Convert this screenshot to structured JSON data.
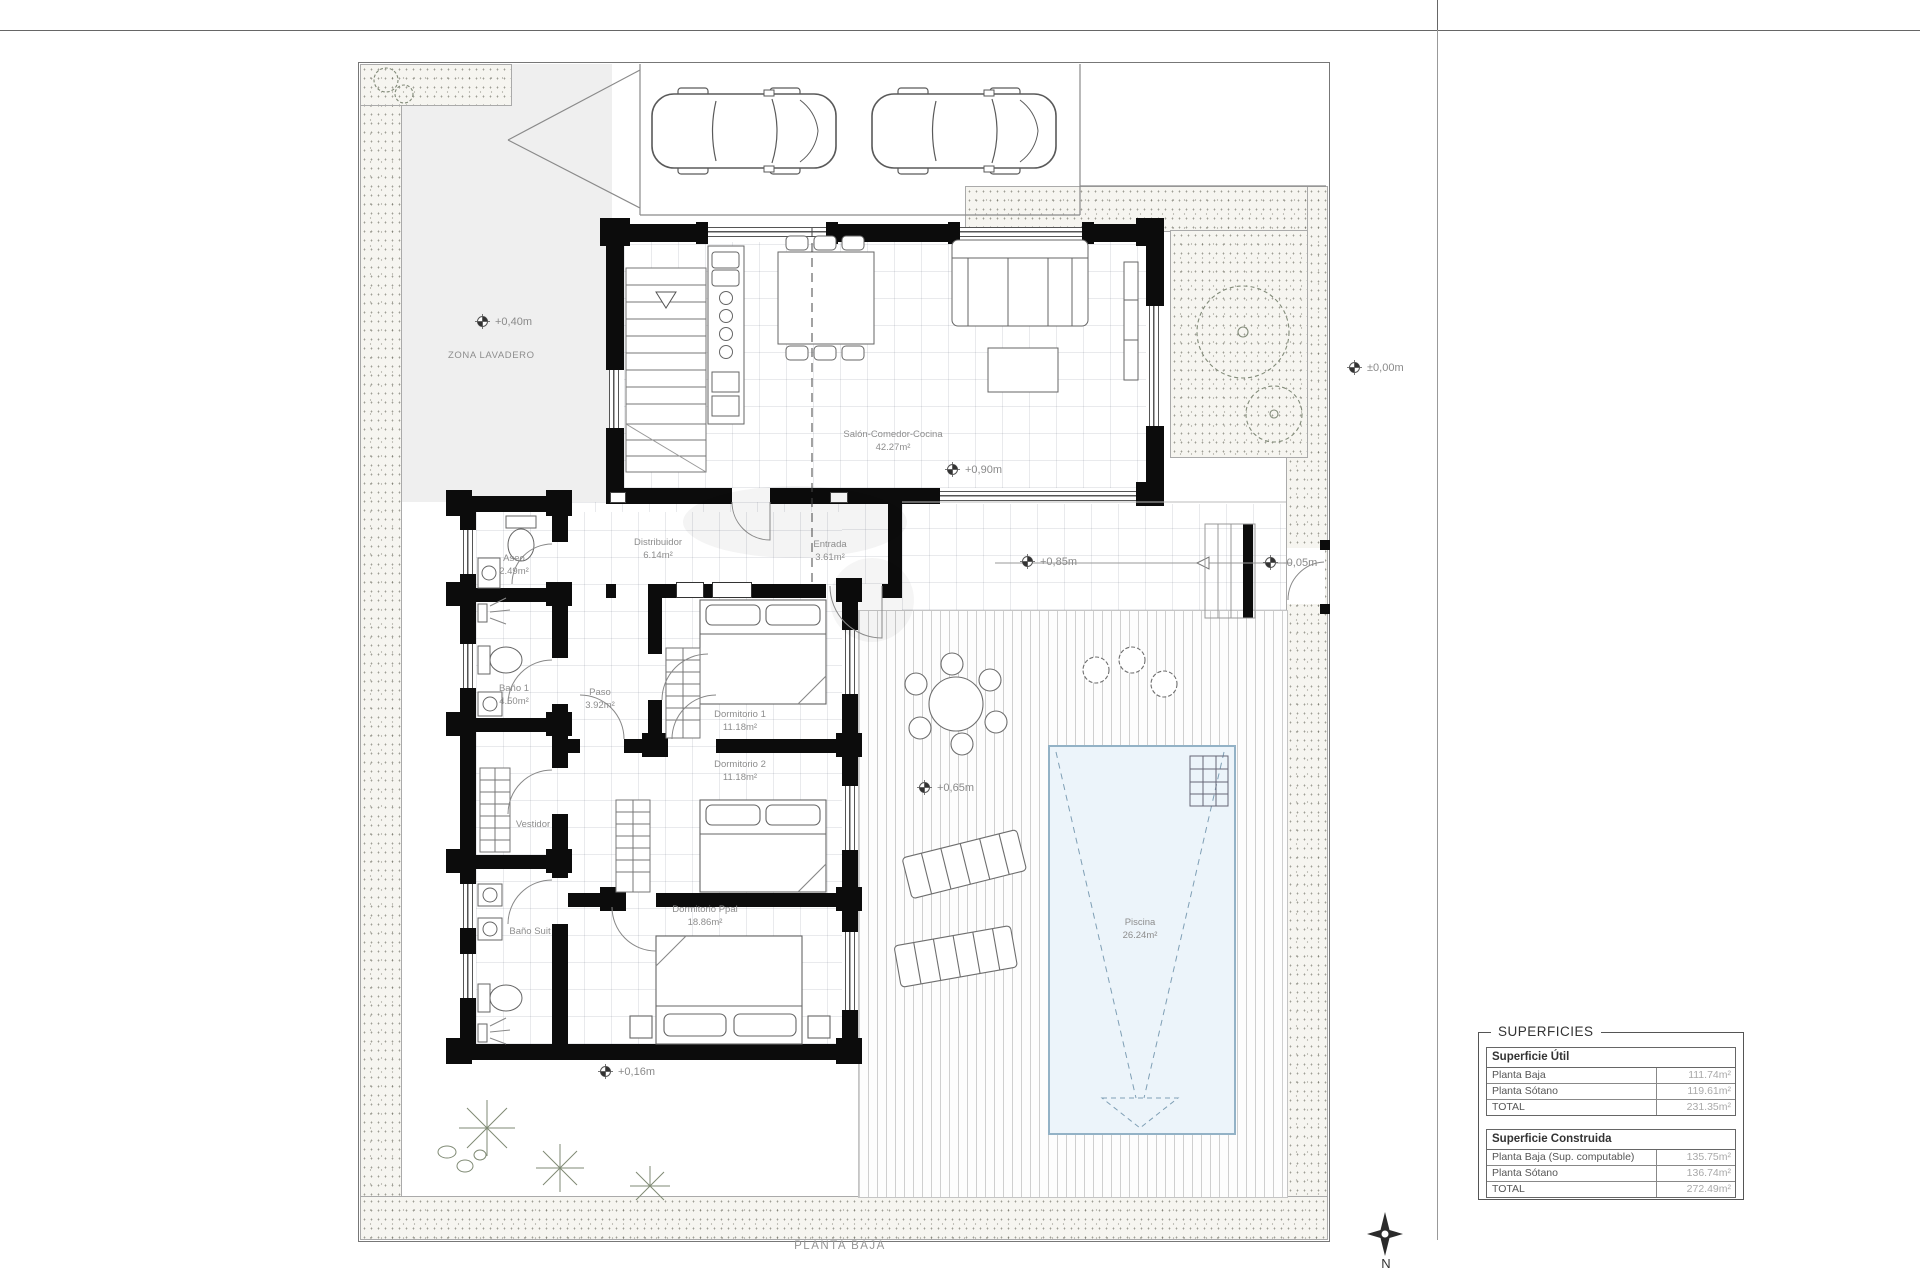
{
  "page": {
    "plan_title": "PLANTA BAJA",
    "north_label": "N",
    "zone_label": "ZONA LAVADERO"
  },
  "rooms": {
    "salon": {
      "name": "Salón-Comedor-Cocina",
      "area": "42.27m²"
    },
    "distribuidor": {
      "name": "Distribuidor",
      "area": "6.14m²"
    },
    "entrada": {
      "name": "Entrada",
      "area": "3.61m²"
    },
    "aseo": {
      "name": "Aseo",
      "area": "2.49m²"
    },
    "bano1": {
      "name": "Baño 1",
      "area": "4.50m²"
    },
    "paso": {
      "name": "Paso",
      "area": "3.92m²"
    },
    "dormitorio1": {
      "name": "Dormitorio 1",
      "area": "11.18m²"
    },
    "dormitorio2": {
      "name": "Dormitorio 2",
      "area": "11.18m²"
    },
    "vestidor": {
      "name": "Vestidor",
      "area": ""
    },
    "banosuit": {
      "name": "Baño Suit",
      "area": ""
    },
    "dormppal": {
      "name": "Dormitorio Ppal",
      "area": "18.86m²"
    },
    "piscina": {
      "name": "Piscina",
      "area": "26.24m²"
    }
  },
  "levels": {
    "lavadero": "+0,40m",
    "calle": "±0,00m",
    "salon": "+0,90m",
    "terraza": "+0,85m",
    "acceso": "-0,05m",
    "solarium": "+0,65m",
    "jardin": "+0,16m"
  },
  "colors": {
    "wall": "#0c0c0c",
    "pool_fill": "#ecf4fa",
    "pool_border": "#93b2c6",
    "label_gray": "#8d8d8d"
  },
  "table": {
    "title": "SUPERFICIES",
    "sections": [
      {
        "header": "Superficie Útil",
        "rows": [
          {
            "label": "Planta Baja",
            "value": "111.74m²"
          },
          {
            "label": "Planta Sótano",
            "value": "119.61m²"
          },
          {
            "label": "TOTAL",
            "value": "231.35m²"
          }
        ]
      },
      {
        "header": "Superficie Construida",
        "rows": [
          {
            "label": "Planta Baja (Sup. computable)",
            "value": "135.75m²"
          },
          {
            "label": "Planta Sótano",
            "value": "136.74m²"
          },
          {
            "label": "TOTAL",
            "value": "272.49m²"
          }
        ]
      }
    ]
  }
}
